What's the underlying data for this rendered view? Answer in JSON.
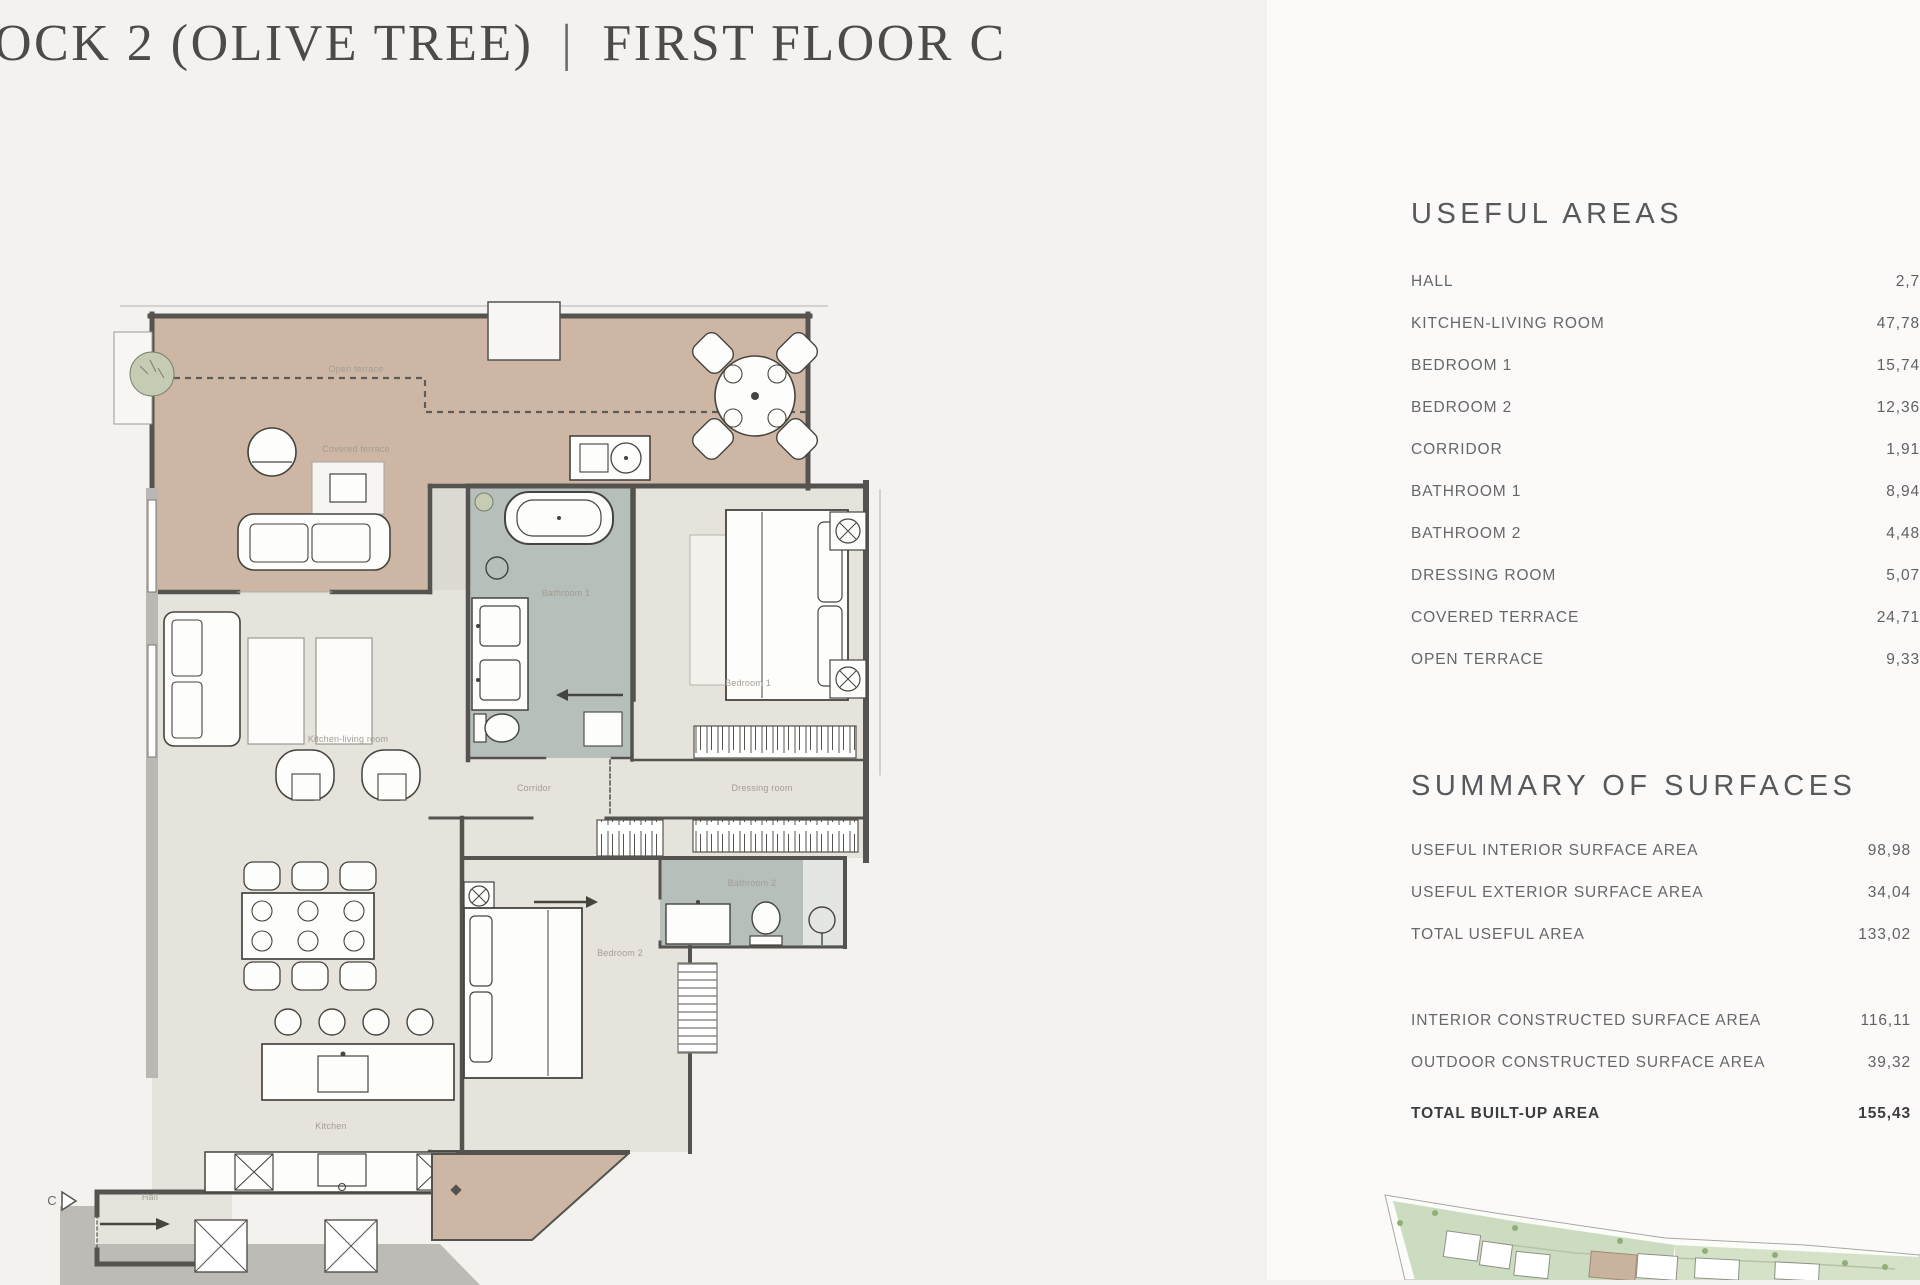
{
  "title": {
    "block": "OCK 2 (OLIVE TREE)",
    "divider": "|",
    "floor": "FIRST FLOOR C"
  },
  "useful_areas": {
    "heading": "USEFUL AREAS",
    "rows": [
      {
        "label": "HALL",
        "value": "2,7"
      },
      {
        "label": "KITCHEN-LIVING ROOM",
        "value": "47,78"
      },
      {
        "label": "BEDROOM 1",
        "value": "15,74"
      },
      {
        "label": "BEDROOM 2",
        "value": "12,36"
      },
      {
        "label": "CORRIDOR",
        "value": "1,91"
      },
      {
        "label": "BATHROOM 1",
        "value": "8,94"
      },
      {
        "label": "BATHROOM 2",
        "value": "4,48"
      },
      {
        "label": "DRESSING ROOM",
        "value": "5,07"
      },
      {
        "label": "COVERED TERRACE",
        "value": "24,71"
      },
      {
        "label": "OPEN TERRACE",
        "value": "9,33"
      }
    ]
  },
  "summary": {
    "heading": "SUMMARY OF SURFACES",
    "groups": [
      [
        {
          "label": "USEFUL INTERIOR SURFACE AREA",
          "value": "98,98"
        },
        {
          "label": "USEFUL EXTERIOR SURFACE AREA",
          "value": "34,04"
        },
        {
          "label": "TOTAL USEFUL AREA",
          "value": "133,02"
        }
      ],
      [
        {
          "label": "INTERIOR CONSTRUCTED SURFACE AREA",
          "value": "116,11"
        },
        {
          "label": "OUTDOOR CONSTRUCTED SURFACE AREA",
          "value": "39,32"
        }
      ]
    ],
    "total": {
      "label": "TOTAL BUILT-UP AREA",
      "value": "155,43"
    }
  },
  "floor_plan": {
    "entry_marker": "C",
    "labels": [
      {
        "text": "Open terrace",
        "x": 356,
        "y": 372
      },
      {
        "text": "Covered terrace",
        "x": 356,
        "y": 452
      },
      {
        "text": "Kitchen-living room",
        "x": 348,
        "y": 742
      },
      {
        "text": "Bathroom 1",
        "x": 566,
        "y": 596
      },
      {
        "text": "Bedroom 1",
        "x": 748,
        "y": 686
      },
      {
        "text": "Corridor",
        "x": 534,
        "y": 791
      },
      {
        "text": "Dressing room",
        "x": 762,
        "y": 791
      },
      {
        "text": "Bathroom 2",
        "x": 752,
        "y": 886
      },
      {
        "text": "Bedroom 2",
        "x": 620,
        "y": 956
      },
      {
        "text": "Kitchen",
        "x": 331,
        "y": 1129
      },
      {
        "text": "Hall",
        "x": 150,
        "y": 1200
      }
    ]
  },
  "colors": {
    "terrace_tan": "#cdb7a4",
    "interior_floor": "#e6e3dd",
    "bathroom_floor": "#b6bfba",
    "wall_dark": "#54534f",
    "wall_light": "#b4b3af",
    "site_green": "#ccdcc0"
  }
}
